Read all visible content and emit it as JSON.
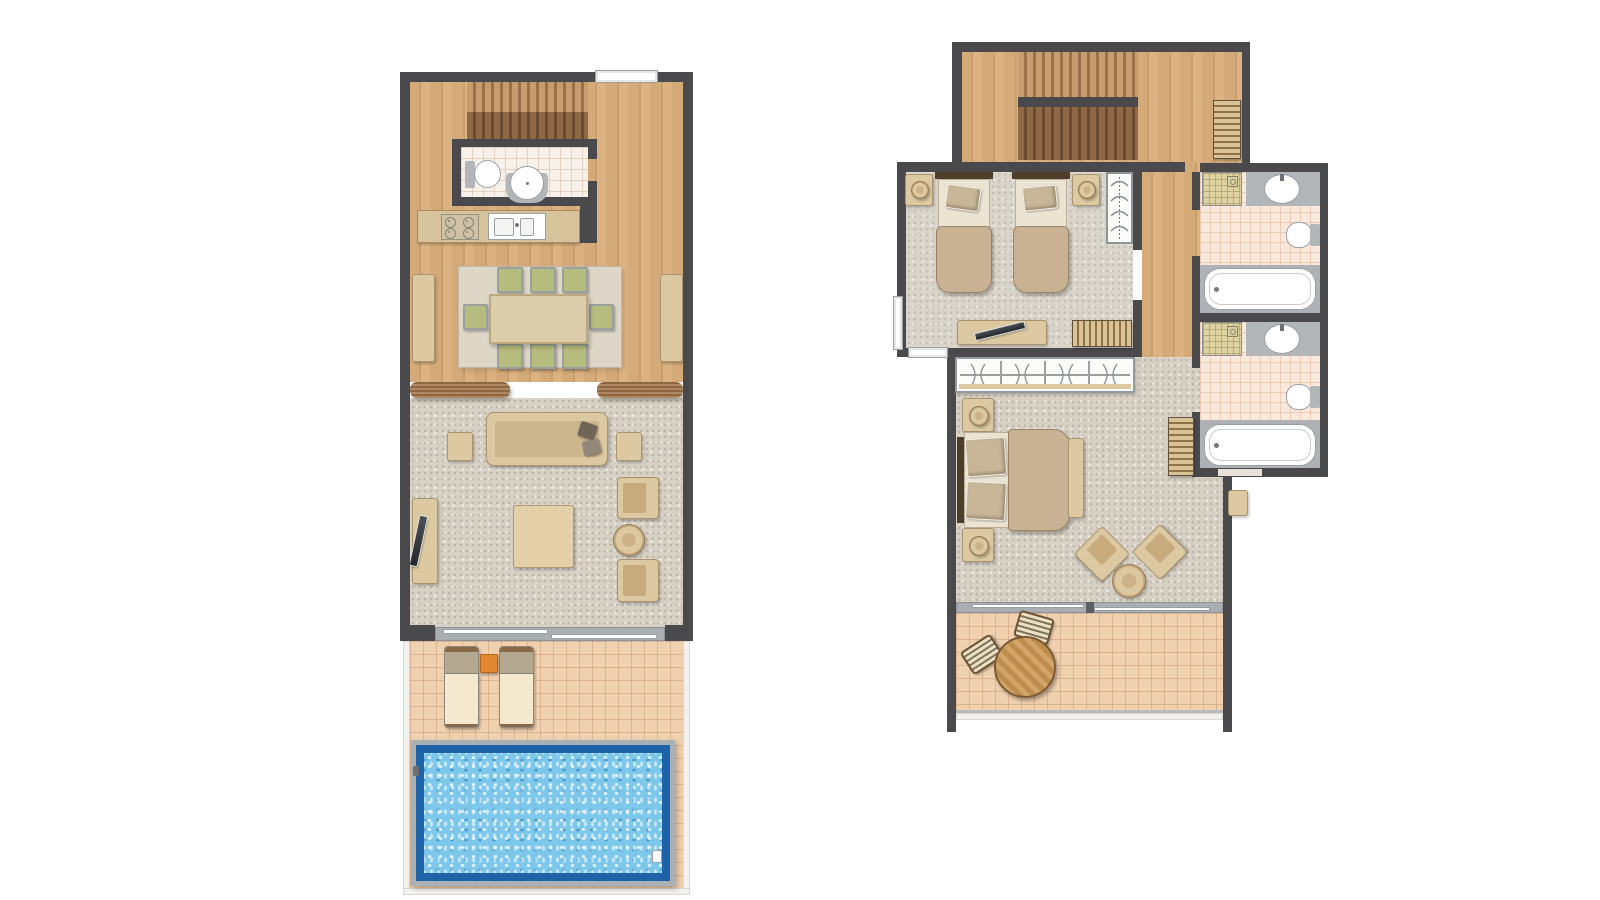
{
  "canvas": {
    "width": 1600,
    "height": 900,
    "background": "#ffffff"
  },
  "palette": {
    "wall": "#4a4a4c",
    "wood": "#d4aa79",
    "wood_dark": "#c99f6e",
    "wood_light": "#dcb283",
    "stair_light": "#c79c6e",
    "stair_light_line": "#9b714a",
    "stair_dark": "#8f6845",
    "stair_dark_line": "#6a4b30",
    "stone_floor": "#d7d1c5",
    "carpet": "#dad5cb",
    "rug": "#ded7c7",
    "terrace_tile": "#efd0af",
    "bath_tile": "#f9e9dc",
    "white_tile": "#f8f1e9",
    "shower_tile": "#ded2a0",
    "furniture": "#dcc9a2",
    "furniture_dark": "#c8ab7d",
    "counter": "#d8c49c",
    "chair_green": "#b6bb7e",
    "bed_duvet": "#c9b193",
    "bed_sheet": "#ece4d2",
    "headboard": "#4f3d2c",
    "metal": "#b3b6b8",
    "track": "#a9aeb3",
    "pool_frame": "#a9b1b7",
    "pool_edge": "#1e63a8",
    "pool_water": "#7cc7ea",
    "orange": "#e08730",
    "step_wood": "#a2754b",
    "border_white": "#f2f1ee"
  },
  "plans": [
    {
      "id": "ground-floor",
      "position": "left",
      "rooms": [
        {
          "name": "entry-deck-stairs"
        },
        {
          "name": "wc"
        },
        {
          "name": "kitchen"
        },
        {
          "name": "dining-room"
        },
        {
          "name": "living-room"
        },
        {
          "name": "terrace"
        },
        {
          "name": "swimming-pool"
        }
      ],
      "furniture": [
        {
          "item": "staircase",
          "count": 1
        },
        {
          "item": "toilet",
          "count": 1
        },
        {
          "item": "washbasin",
          "count": 1
        },
        {
          "item": "cooktop",
          "count": 1
        },
        {
          "item": "kitchen-sink",
          "count": 1
        },
        {
          "item": "dining-table",
          "count": 1
        },
        {
          "item": "dining-chair",
          "count": 8
        },
        {
          "item": "sideboard",
          "count": 2
        },
        {
          "item": "sofa",
          "count": 1
        },
        {
          "item": "side-table",
          "count": 2
        },
        {
          "item": "tv-console",
          "count": 1
        },
        {
          "item": "coffee-table",
          "count": 1
        },
        {
          "item": "armchair",
          "count": 2
        },
        {
          "item": "round-table",
          "count": 1
        },
        {
          "item": "sun-lounger",
          "count": 2
        },
        {
          "item": "cube-table",
          "count": 1
        }
      ]
    },
    {
      "id": "upper-floor",
      "position": "right",
      "rooms": [
        {
          "name": "stair-hall"
        },
        {
          "name": "twin-bedroom"
        },
        {
          "name": "hallway"
        },
        {
          "name": "bathroom-1"
        },
        {
          "name": "bathroom-2"
        },
        {
          "name": "master-bedroom"
        },
        {
          "name": "balcony"
        }
      ],
      "furniture": [
        {
          "item": "staircase",
          "count": 1
        },
        {
          "item": "shelf",
          "count": 1
        },
        {
          "item": "single-bed",
          "count": 2
        },
        {
          "item": "nightstand",
          "count": 4
        },
        {
          "item": "wardrobe",
          "count": 1
        },
        {
          "item": "tv-console",
          "count": 1
        },
        {
          "item": "dresser",
          "count": 2
        },
        {
          "item": "built-in-closet",
          "count": 1
        },
        {
          "item": "double-bed",
          "count": 1
        },
        {
          "item": "bed-bench",
          "count": 1
        },
        {
          "item": "armchair",
          "count": 2
        },
        {
          "item": "round-side-table",
          "count": 1
        },
        {
          "item": "shower",
          "count": 2
        },
        {
          "item": "washbasin",
          "count": 2
        },
        {
          "item": "toilet",
          "count": 2
        },
        {
          "item": "bathtub",
          "count": 2
        },
        {
          "item": "bistro-table",
          "count": 1
        },
        {
          "item": "bistro-chair",
          "count": 2
        },
        {
          "item": "door-mat",
          "count": 1
        }
      ]
    }
  ]
}
